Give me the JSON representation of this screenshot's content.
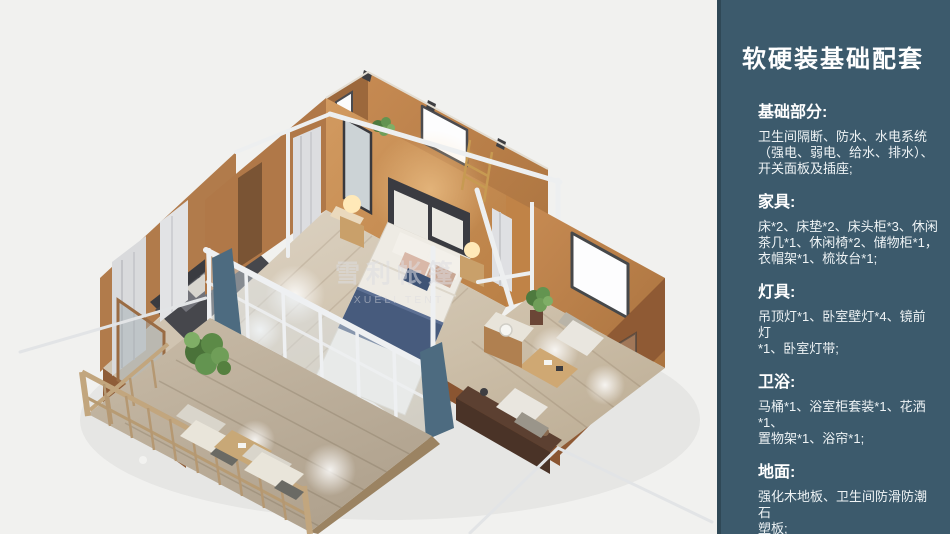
{
  "page": {
    "background": "#f1f1ef"
  },
  "sidebar": {
    "background": "#3c5a6c",
    "text_color": "#ffffff",
    "title": "软硬装基础配套",
    "sections": [
      {
        "heading": "基础部分:",
        "body": "卫生间隔断、防水、水电系统\n（强电、弱电、给水、排水）、\n开关面板及插座;"
      },
      {
        "heading": "家具:",
        "body": "床*2、床垫*2、床头柜*3、休闲\n茶几*1、休闲椅*2、储物柜*1，\n衣帽架*1、梳妆台*1;"
      },
      {
        "heading": "灯具:",
        "body": "吊顶灯*1、卧室壁灯*4、镜前灯\n*1、卧室灯带;"
      },
      {
        "heading": "卫浴:",
        "body": "马桶*1、浴室柜套装*1、花洒*1、\n置物架*1、浴帘*1;"
      },
      {
        "heading": "地面:",
        "body": "强化木地板、卫生间防滑防潮石\n塑板;"
      }
    ]
  },
  "illustration": {
    "description": "轴测视角帐篷套房渲染：中央卧室、卫生间、休闲区与观景露台",
    "watermark_cn": "雪利帐篷",
    "watermark_en": "XUELI TENT",
    "palette": {
      "wall_tan": "#c08a52",
      "wall_shadow": "#9c683c",
      "floor_wood": "#d6cbb8",
      "deck_wood": "#c3b6a3",
      "frame_white": "#eef0f2",
      "bedding_white": "#eeebe4",
      "bed_runner_navy": "#475b7d",
      "plant_green": "#5c8a47",
      "curtain_gray": "#d9dadc",
      "curtain_blue": "#4d6b80"
    }
  }
}
